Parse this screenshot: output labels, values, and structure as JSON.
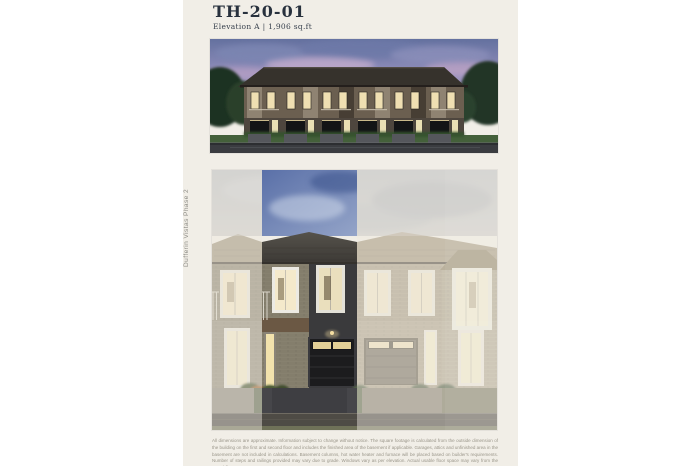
{
  "header": {
    "title": "TH-20-01",
    "subtitle": "Elevation A | 1,906 sq.ft"
  },
  "side": {
    "vertical_label": "Dufferin Vistas Phase 2"
  },
  "images": {
    "hero_label": "streetscape-dusk-rendering",
    "elevation_label": "front-elevation-highlight-rendering"
  },
  "footer": {
    "disclaimer": "All dimensions are approximate. Information subject to change without notice. The square footage is calculated from the outside dimension of the building on the first and second floor and includes the finished area of the basement if applicable. Garages, attics and unfinished area in the basement are not included in calculations. Basement columns, hot water heater and furnace will be placed based on builder's requirements. Number of steps and railings provided may vary due to grade. Windows vary as per elevation. Actual usable floor space may vary from the stated floor area. E.&O.E."
  },
  "colors": {
    "page_background": "#ffffff",
    "panel_cream": "#f1eee7",
    "title_ink": "#28313d",
    "muted_label": "#8c8b85",
    "disclaimer_gray": "#9a968a",
    "highlight_sky_blue": "#5a70a8",
    "garage_black": "#1c1c1e",
    "window_lit": "#f4e9cb"
  }
}
